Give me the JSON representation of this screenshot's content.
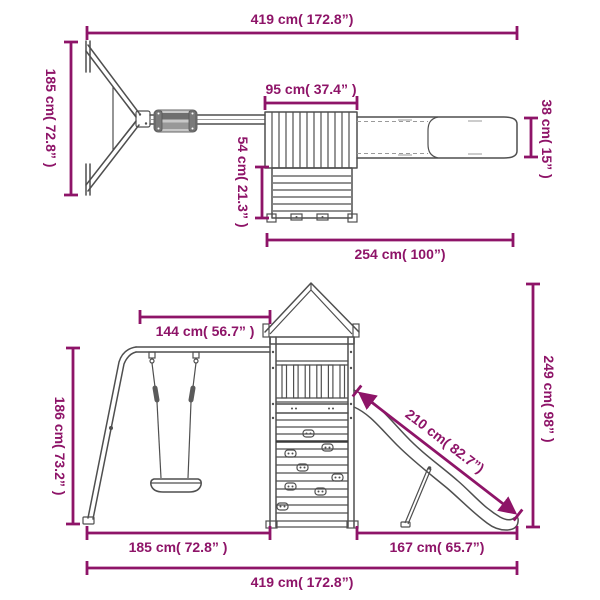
{
  "colors": {
    "dimension": "#8E1468",
    "structure": "#4F4F4F",
    "structure_light": "#9A9A9A",
    "background": "#FFFFFF"
  },
  "views": {
    "top_view": {
      "dimensions": {
        "total_length": "419 cm( 172.8”)",
        "swing_frame_width": "185 cm( 72.8” )",
        "roof_length": "95 cm( 37.4” )",
        "platform_depth": "54 cm( 21.3” )",
        "slide_width": "38 cm( 15” )",
        "tower_and_slide_length": "254 cm( 100”)"
      }
    },
    "front_view": {
      "dimensions": {
        "swing_beam_length": "144 cm( 56.7” )",
        "swing_frame_height": "186 cm( 73.2” )",
        "slide_length": "210 cm( 82.7”)",
        "total_height": "249 cm( 98” )",
        "swing_section_width": "185 cm( 72.8” )",
        "slide_section_width": "167 cm( 65.7”)",
        "total_length": "419 cm( 172.8”)"
      }
    }
  }
}
